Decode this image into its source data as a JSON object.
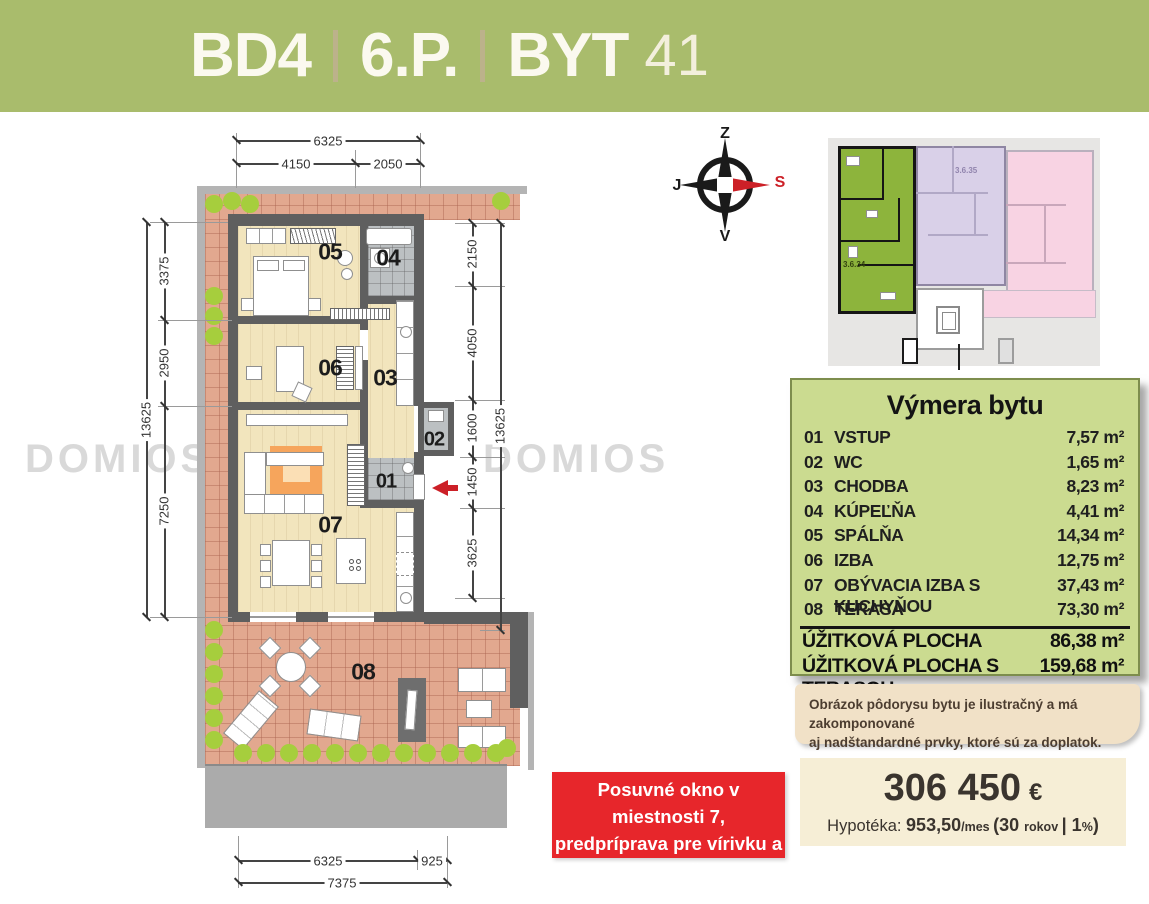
{
  "header": {
    "project": "BD4",
    "separator": "|",
    "floor": "6.P.",
    "unit_label": "BYT",
    "unit_number": "41"
  },
  "compass": {
    "top": "Z",
    "right": "S",
    "bottom": "V",
    "left": "J"
  },
  "watermark": {
    "text": "DOMIOS"
  },
  "plan": {
    "rooms": {
      "r01": "01",
      "r02": "02",
      "r03": "03",
      "r04": "04",
      "r05": "05",
      "r06": "06",
      "r07": "07",
      "r08": "08"
    },
    "dims": {
      "top_total": "6325",
      "top_a": "4150",
      "top_b": "2050",
      "left_total": "13625",
      "left_a": "3375",
      "left_b": "2950",
      "left_c": "7250",
      "right_total": "13625",
      "right_a": "2150",
      "right_b": "4050",
      "right_c": "1600",
      "right_d": "1450",
      "right_e": "3625",
      "bottom_a": "6325",
      "bottom_b": "925",
      "bottom_total": "7375"
    }
  },
  "site_plan": {
    "label_green": "3.6.34",
    "label_purple": "3.6.35"
  },
  "area_table": {
    "title": "Výmera bytu",
    "rows": [
      {
        "num": "01",
        "name": "VSTUP",
        "value": "7,57 m²"
      },
      {
        "num": "02",
        "name": "WC",
        "value": "1,65 m²"
      },
      {
        "num": "03",
        "name": "CHODBA",
        "value": "8,23 m²"
      },
      {
        "num": "04",
        "name": "KÚPEĽŇA",
        "value": "4,41 m²"
      },
      {
        "num": "05",
        "name": "SPÁLŇA",
        "value": "14,34 m²"
      },
      {
        "num": "06",
        "name": "IZBA",
        "value": "12,75 m²"
      },
      {
        "num": "07",
        "name": "OBÝVACIA IZBA S KUCHYŇOU",
        "value": "37,43 m²"
      },
      {
        "num": "08",
        "name": "TERASA",
        "value": "73,30 m²"
      }
    ],
    "totals": [
      {
        "name": "ÚŽITKOVÁ PLOCHA",
        "value": "86,38 m²"
      },
      {
        "name": "ÚŽITKOVÁ PLOCHA S TERASOU",
        "value": "159,68 m²"
      }
    ]
  },
  "disclaimer": {
    "line1": "Obrázok pôdorysu bytu je ilustračný a má zakomponované",
    "line2": "aj nadštandardné prvky, ktoré sú za doplatok."
  },
  "note": {
    "line1": "Posuvné okno v miestnosti 7,",
    "line2": "predpríprava pre vírivku a vonkajší",
    "line3": "guľový ventil v cene bytu"
  },
  "price": {
    "amount": "306 450",
    "currency": "€",
    "seg1": "Hypotéka: ",
    "seg2": "953,50",
    "seg3": "/mes ",
    "seg4": "(30 ",
    "seg5": "rokov ",
    "seg6": "| 1",
    "seg7": "%",
    "seg8": ")"
  },
  "colors": {
    "header_green": "#a9bc6c",
    "panel_green": "#cbdb90",
    "note_red": "#e7262b",
    "beige": "#f1e1c7",
    "cream": "#f6eed6",
    "wall": "#5f5f5f",
    "wood": "#f2e5bd",
    "tile": "#bcc0c2",
    "terrace": "#e2a88f",
    "bush": "#a6ce3d",
    "site_green": "#8db43c",
    "site_purple": "#d9d0e8",
    "site_pink": "#f8d3e3",
    "accent_red": "#cc2027"
  }
}
